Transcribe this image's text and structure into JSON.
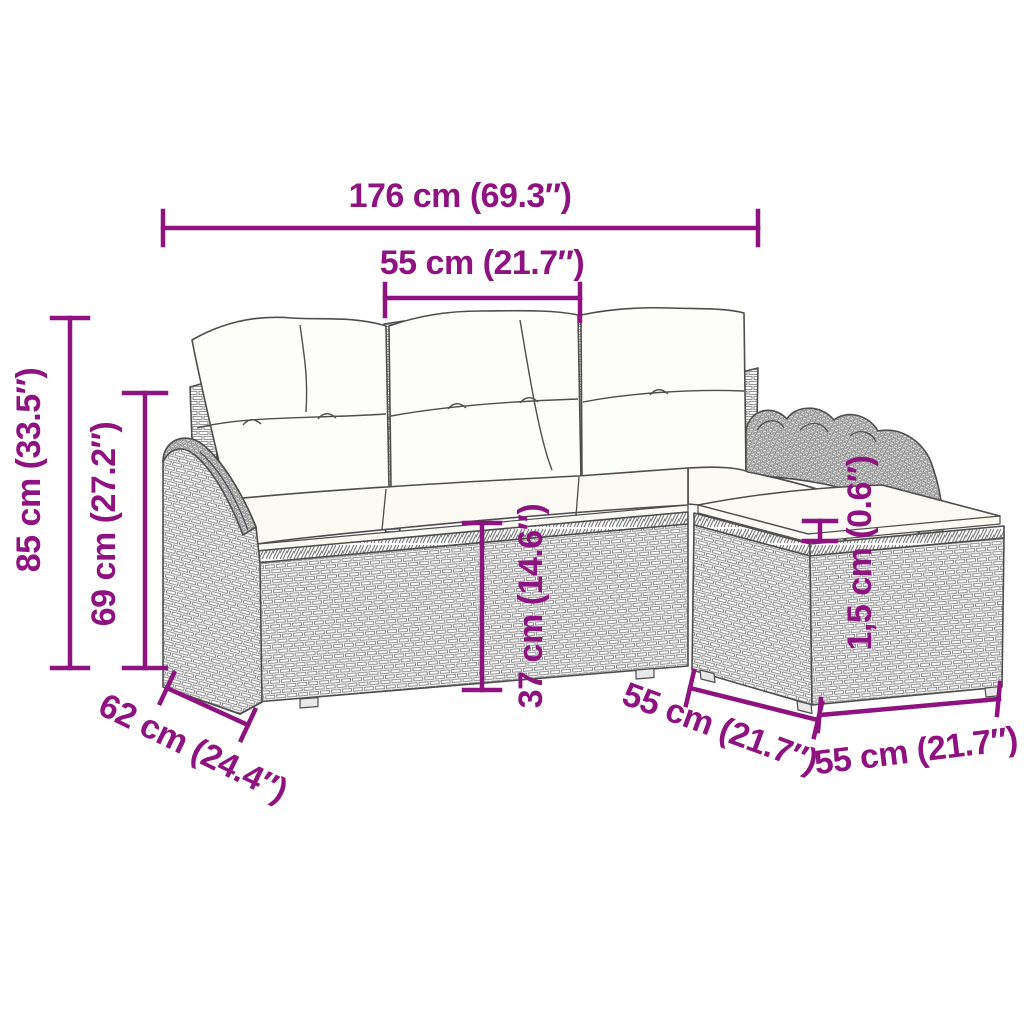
{
  "figure": {
    "alt": "Line drawing of a poly rattan garden sofa set (3-seater sofa with back cushions, seat cushions and footstool) annotated with dimensions",
    "colors": {
      "background": "#ffffff",
      "dimension_accent": "#8E1280",
      "sketch_outline": "#4d4d4d",
      "weave_line": "#8d8d8d",
      "cushion_fill": "#fbfaf5"
    },
    "dimensions": {
      "total_width": {
        "text": "176 cm (69.3″)"
      },
      "seat_width": {
        "text": "55 cm (21.7″)"
      },
      "total_height": {
        "text": "85 cm (33.5″)"
      },
      "back_height": {
        "text": "69 cm (27.2″)"
      },
      "seat_height": {
        "text": "37 cm (14.6″)"
      },
      "cushion_thickness": {
        "text": "1,5 cm (0.6″)"
      },
      "side_depth": {
        "text": "62 cm (24.4″)"
      },
      "ottoman_depth": {
        "text": "55 cm (21.7″)"
      },
      "ottoman_width": {
        "text": "55 cm (21.7″)"
      }
    }
  }
}
